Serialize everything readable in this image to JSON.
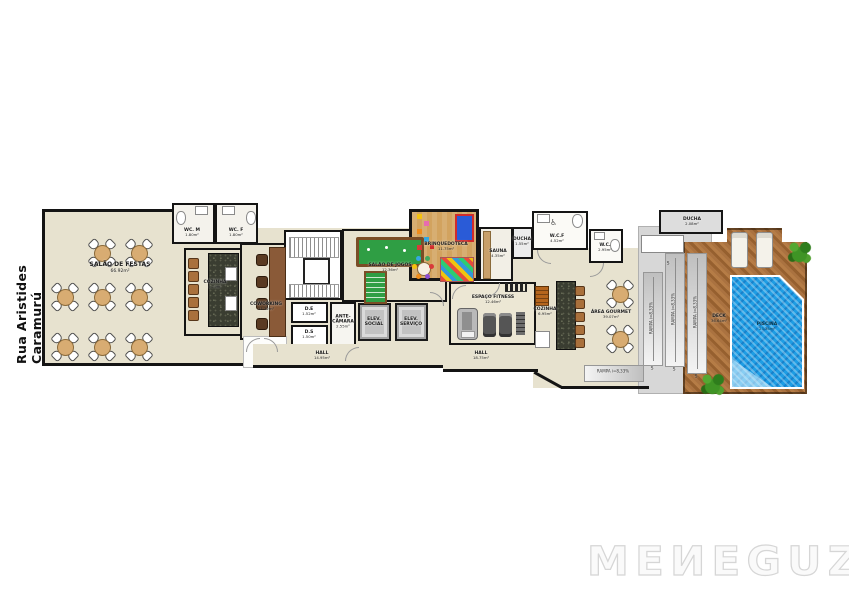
{
  "street_name": "Rua Aristides Caramurú",
  "logo": {
    "text": "MEИEGUZ",
    "brand": "MENEGUZ"
  },
  "rooms": {
    "salao_festas": {
      "name": "SALÃO DE FESTAS",
      "area": "66.92m²"
    },
    "wc_m": {
      "name": "WC. M",
      "area": "1.80m²"
    },
    "wc_f": {
      "name": "WC. F",
      "area": "1.80m²"
    },
    "cozinha1": {
      "name": "COZINHA",
      "area": "9.79m²"
    },
    "coworking": {
      "name": "COWORKING",
      "area": "11.32m²"
    },
    "salao_jogos": {
      "name": "SALÃO DE JOGOS",
      "area": "12.36m²"
    },
    "brinquedoteca": {
      "name": "BRINQUEDOTECA",
      "area": "11.75m²"
    },
    "sauna": {
      "name": "SAUNA",
      "area": "4.35m²"
    },
    "ducha1": {
      "name": "DUCHA",
      "area": "1.55m²"
    },
    "wcf": {
      "name": "W.C.F",
      "area": "4.52m²"
    },
    "wc2": {
      "name": "W.C.",
      "area": "2.95m²"
    },
    "de": {
      "name": "D.E",
      "area": "1.52m²"
    },
    "ds": {
      "name": "D.S",
      "area": "1.50m²"
    },
    "antecamara": {
      "name": "ANTE-CÂMARA",
      "area": "2.55m²"
    },
    "elev_social": {
      "name": "ELEV. SOCIAL"
    },
    "elev_servico": {
      "name": "ELEV. SERVIÇO"
    },
    "hall1": {
      "name": "HALL",
      "area": "14.95m²"
    },
    "hall2": {
      "name": "HALL",
      "area": "18.75m²"
    },
    "fitness": {
      "name": "ESPAÇO FITNESS",
      "area": "12.46m²"
    },
    "cozinha2": {
      "name": "COZINHA",
      "area": "6.95m²"
    },
    "area_gourmet": {
      "name": "ÁREA GOURMET",
      "area": "39.07m²"
    },
    "ducha2": {
      "name": "DUCHA",
      "area": "2.08m²"
    },
    "deck": {
      "name": "DECK",
      "area": "36.64m²"
    },
    "piscina": {
      "name": "PISCINA",
      "area": "23.36m²"
    }
  },
  "ramps": {
    "label": "RAMPA i=8,33%",
    "direction_mark": "S"
  },
  "colors": {
    "floor_beige": "#e7e2cf",
    "wall_black": "#141414",
    "granite_dark": "#3a3d31",
    "toy_floor_tan": "#d2a35f",
    "deck_wood": "#a9713c",
    "pool_blue": "#1e9de4",
    "table_tan": "#d8ac72",
    "service_gray": "#d7d7d7",
    "logo_gray": "#d6d6d6"
  }
}
